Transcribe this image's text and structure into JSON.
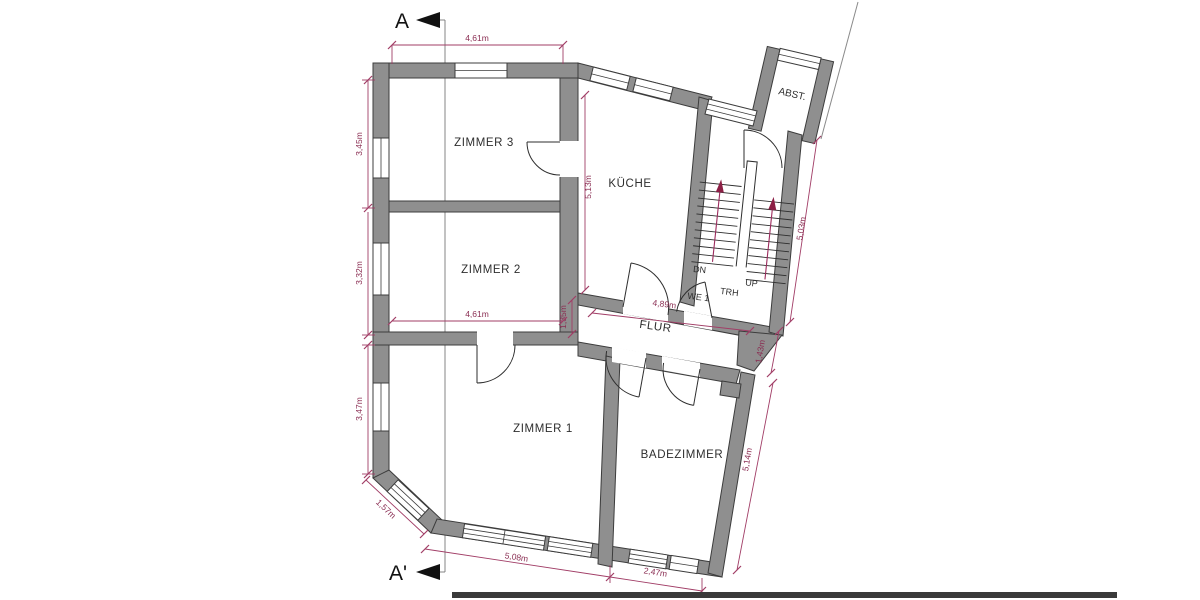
{
  "plan": {
    "title": "floor-plan",
    "rooms": {
      "zimmer3": "ZIMMER 3",
      "zimmer2": "ZIMMER 2",
      "zimmer1": "ZIMMER 1",
      "kueche": "KÜCHE",
      "badezimmer": "BADEZIMMER",
      "flur": "FLUR",
      "trh": "TRH",
      "we1": "WE 1",
      "abst": "ABST."
    },
    "stairs": {
      "dn": "DN",
      "up": "UP"
    },
    "section": {
      "top": "A",
      "bottom": "A'"
    },
    "dimensions": {
      "z3_width": "4,61m",
      "z3_height": "3,45m",
      "z2_height": "3,32m",
      "z1_left_height": "3,47m",
      "chamfer": "1,57m",
      "z1_bottom": "5,08m",
      "bad_bottom": "2,47m",
      "bad_right": "5,14m",
      "flur_right": "1,43m",
      "stair_right": "5,03m",
      "kueche_height": "5,13m",
      "flur_left": "1,35m",
      "flur_width": "4,89m",
      "z2_width": "4,61m"
    },
    "colors": {
      "wall_fill": "#8f8f8f",
      "wall_outline": "#3c3c3c",
      "dimension_line": "#a13d66",
      "dimension_text": "#8a2d52",
      "section_line": "#787878"
    }
  }
}
